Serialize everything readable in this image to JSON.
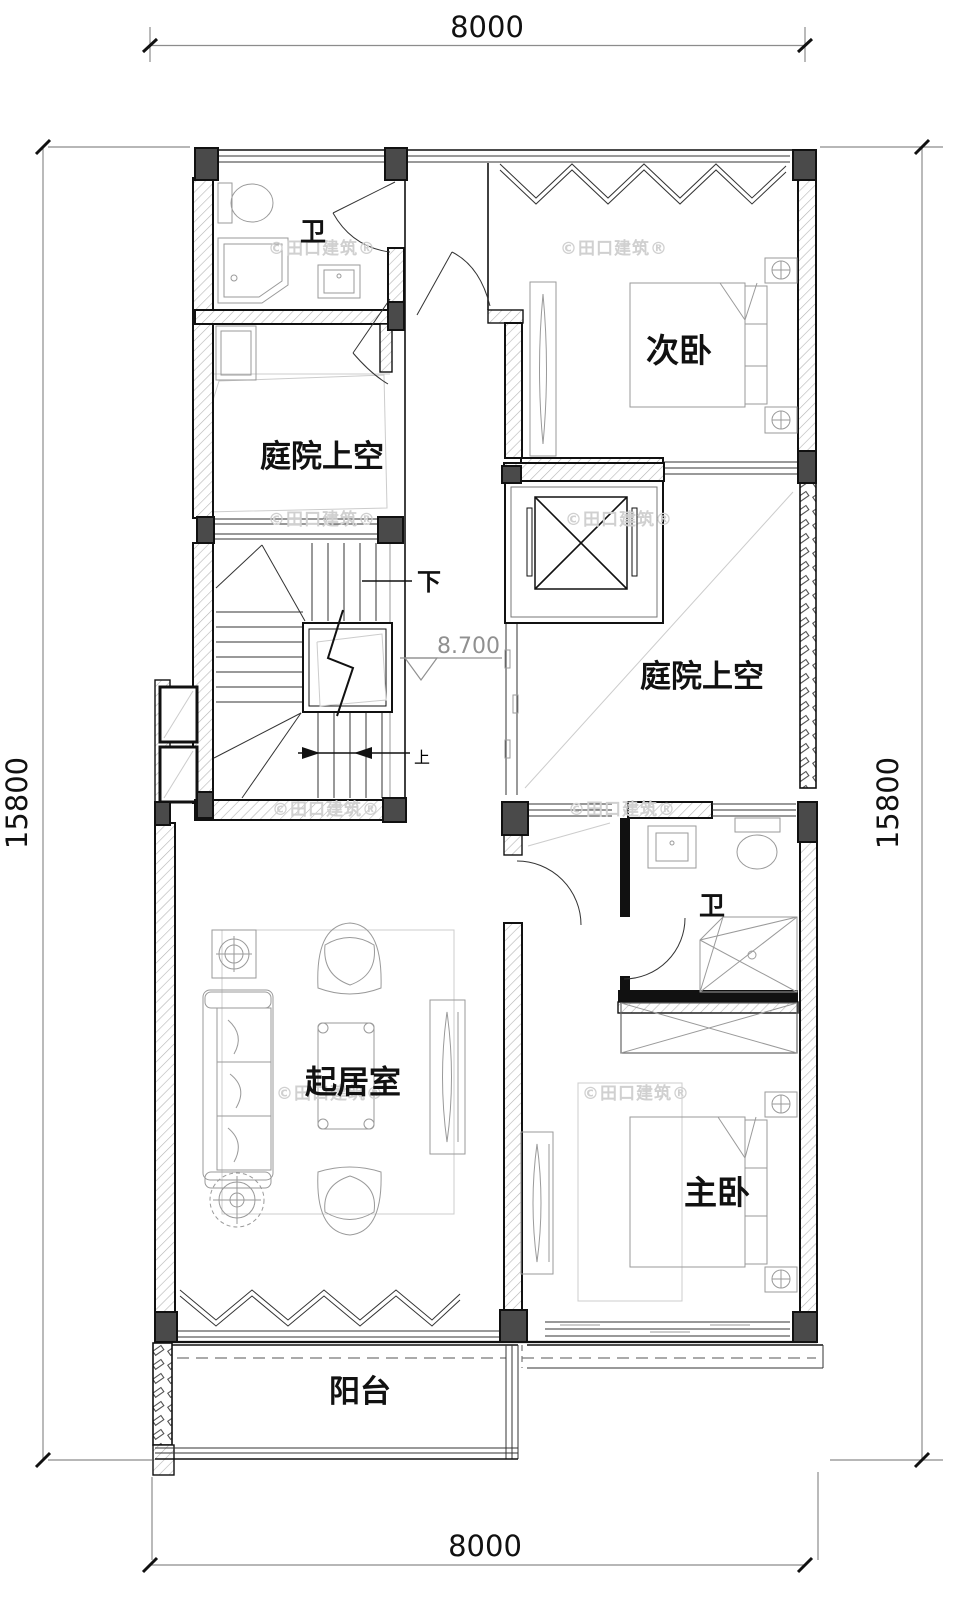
{
  "dimensions": {
    "top": "8000",
    "bottom": "8000",
    "left": "15800",
    "right": "15800"
  },
  "rooms": {
    "bath_upper": "卫",
    "courtyard_upper": "庭院上空",
    "secondary_bedroom": "次卧",
    "courtyard_right": "庭院上空",
    "bath_lower": "卫",
    "living_room": "起居室",
    "master_bedroom": "主卧",
    "balcony": "阳台"
  },
  "stairs": {
    "down": "下",
    "up": "上",
    "elevation": "8.700"
  },
  "watermark": {
    "text": "©田口建筑®"
  },
  "colors": {
    "line": "#111111",
    "furniture": "#9a9a9a",
    "hatch": "#b5b5b5",
    "column_fill": "#4a4a4a",
    "dimension": "#8c8c8c",
    "watermark": "#d0d0d0",
    "elevation_marker": "#909090"
  }
}
